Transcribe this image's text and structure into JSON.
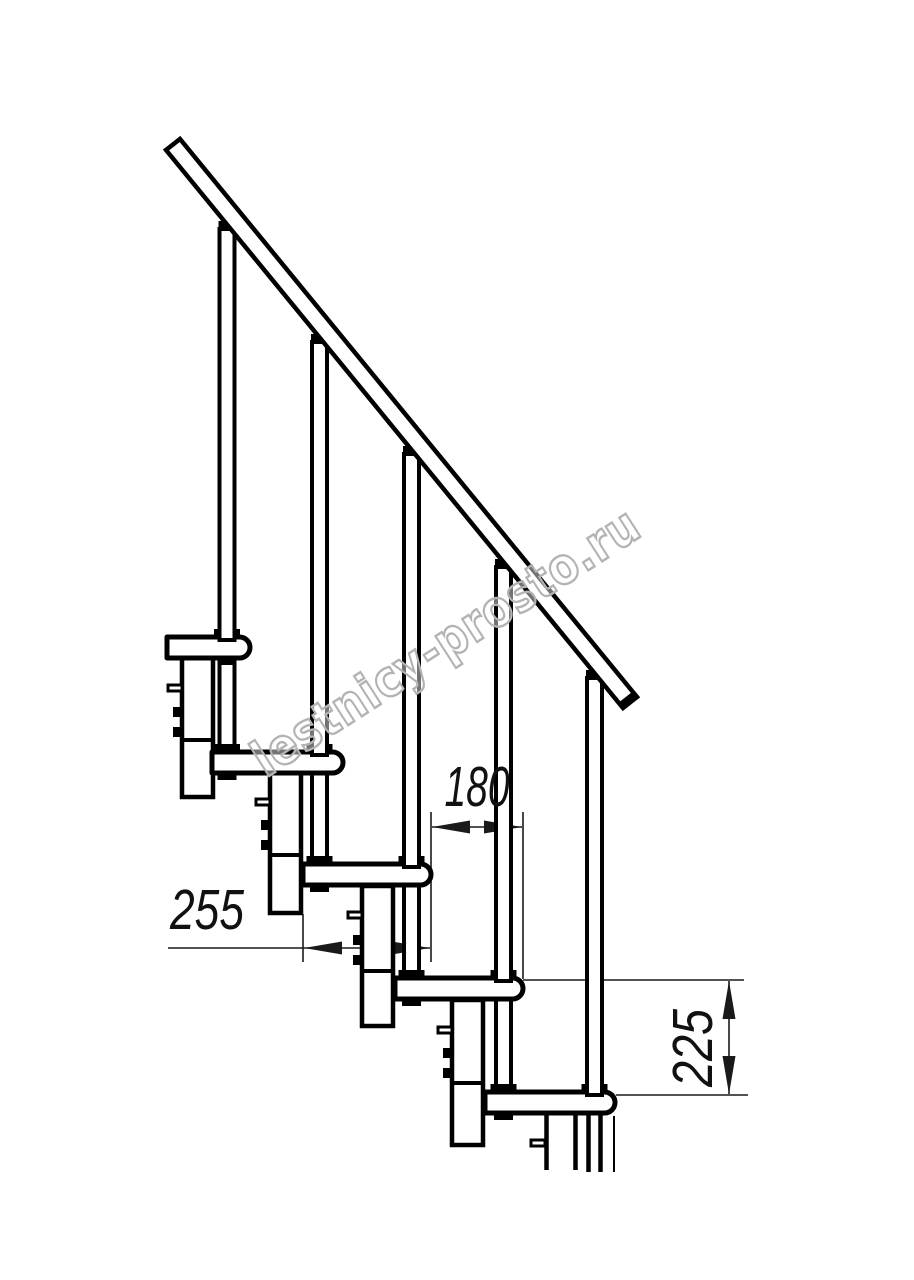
{
  "drawing": {
    "watermark": "lestnicy-prosto.ru",
    "dimensions": {
      "step_overlap": "180",
      "tread_depth": "255",
      "step_height": "225"
    },
    "counts": {
      "treads_visible": 5,
      "balusters_visible": 5
    },
    "colors": {
      "line": "#000000",
      "dimension_line": "#1a1a1a",
      "watermark": "#b3b3b3",
      "background": "#ffffff"
    }
  }
}
